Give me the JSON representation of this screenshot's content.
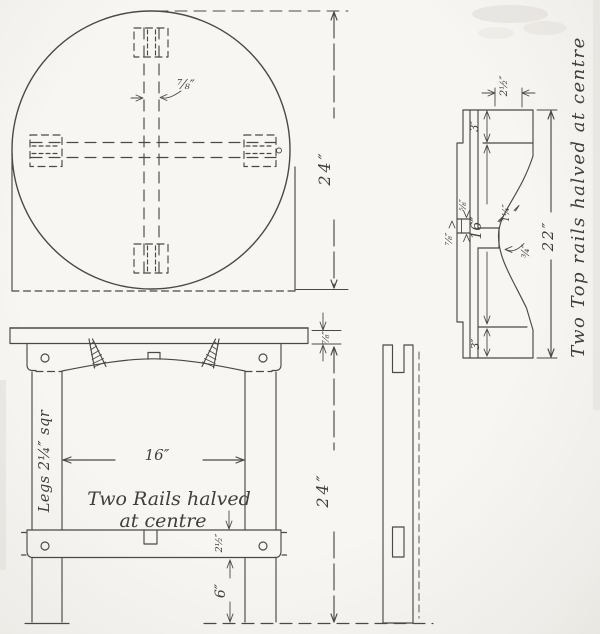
{
  "drawing": {
    "plan_view": {
      "rail_thickness_label": "⅞″",
      "diameter_label": "24″"
    },
    "front_view": {
      "top_thickness_label": "⅞″",
      "leg_spacing_label": "16″",
      "note_line1": "Two Rails halved",
      "note_line2": "at centre",
      "legs_label": "Legs 2¼″ sqr",
      "lower_rail_width_label": "2½″",
      "rail_to_floor_label": "6″",
      "leg_height_label": "24″"
    },
    "rail_detail": {
      "caption": "Two Top rails halved at centre",
      "overall_length_label": "22″",
      "between_shoulders_label": "16″",
      "end_length_top_label": "3″",
      "end_length_bottom_label": "3″",
      "end_width_label": "2½″",
      "thickness_label": "⅞″",
      "halving_label": "⅝″",
      "notch_width_label": "1¼″",
      "notch_depth_label": "¾″"
    }
  }
}
